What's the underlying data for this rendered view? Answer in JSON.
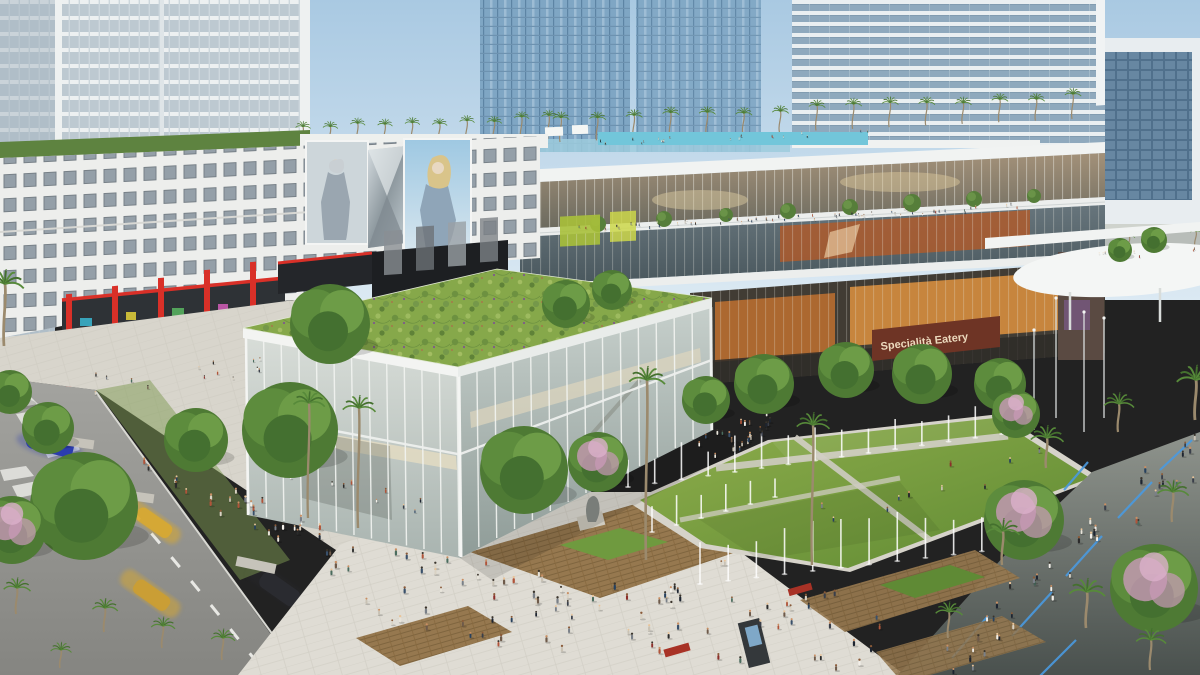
{
  "meta": {
    "title": "Aerial rendering of a mixed-use urban plaza development",
    "type": "architectural-rendering",
    "time_of_day": "day"
  },
  "signs": {
    "eatery": "Specialità Eatery"
  },
  "palette": {
    "sky_top": "#a9c9e2",
    "sky_bottom": "#dbe9f3",
    "green_roof": "#86a84a",
    "lawn_light": "#8fae4c",
    "lawn_dark": "#5f8a33",
    "pavement": "#dfdcd4",
    "promenade": "#5c6360",
    "street": "#9e9e9a",
    "glass_blue": "#7fa6c4",
    "glass_cool": "#55656d",
    "glass_warm": "#97876d",
    "food_hall_glow": "#d98f3f",
    "retail_red": "#d93028",
    "sign_brown": "#6e3425",
    "sign_text": "#ecd9bd",
    "white_structure": "#f1f3f2",
    "palm_green": "#4e7c34",
    "flower_pink": "#c99ab8",
    "led_blue": "#4a9ae0",
    "taxi_yellow": "#d9a92f",
    "car_blue": "#2b3cae",
    "people_colors": [
      "#1d2430",
      "#3a3f4a",
      "#f2efe9",
      "#7a8088",
      "#27415e",
      "#8c2f2a",
      "#c9c2b4",
      "#4a6c5e",
      "#2b2b2b",
      "#6e5a4a",
      "#b0543a",
      "#e8e4da",
      "#39506b",
      "#d9d2c4"
    ],
    "skin_tones": [
      "#e8c49a",
      "#c98f63",
      "#8a5a38",
      "#3a342c"
    ]
  },
  "scenery": {
    "palm_rows": [
      {
        "x1": 302,
        "x2": 548,
        "y": 146,
        "m": -0.03,
        "n": 10,
        "t": 18,
        "s": 0.5
      },
      {
        "x1": 560,
        "x2": 1072,
        "y": 142,
        "m": -0.045,
        "n": 15,
        "t": 20,
        "s": 0.55
      },
      {
        "x1": 1095,
        "x2": 1195,
        "y": 252,
        "m": -0.05,
        "n": 4,
        "t": 13,
        "s": 0.38
      }
    ],
    "bush_rows": [
      {
        "x1": 6,
        "x2": 300,
        "y": 152,
        "m": -0.033,
        "n": 16,
        "r": 6
      }
    ],
    "palms": [
      {
        "x": 16,
        "y": 614,
        "t": 26,
        "s": 0.9
      },
      {
        "x": 104,
        "y": 632,
        "t": 24,
        "s": 0.85
      },
      {
        "x": 162,
        "y": 648,
        "t": 22,
        "s": 0.8
      },
      {
        "x": 222,
        "y": 660,
        "t": 22,
        "s": 0.8
      },
      {
        "x": 60,
        "y": 668,
        "t": 18,
        "s": 0.7
      },
      {
        "x": 4,
        "y": 346,
        "t": 62,
        "s": 1.25
      },
      {
        "x": 308,
        "y": 518,
        "t": 115,
        "s": 1.05
      },
      {
        "x": 358,
        "y": 528,
        "t": 120,
        "s": 1.1
      },
      {
        "x": 646,
        "y": 560,
        "t": 180,
        "s": 1.2
      },
      {
        "x": 812,
        "y": 565,
        "t": 140,
        "s": 1.1
      },
      {
        "x": 1046,
        "y": 468,
        "t": 30,
        "s": 1.1
      },
      {
        "x": 1118,
        "y": 432,
        "t": 28,
        "s": 1.0
      },
      {
        "x": 1002,
        "y": 565,
        "t": 34,
        "s": 1.1
      },
      {
        "x": 1086,
        "y": 628,
        "t": 36,
        "s": 1.2
      },
      {
        "x": 1172,
        "y": 522,
        "t": 30,
        "s": 1.05
      },
      {
        "x": 1150,
        "y": 670,
        "t": 30,
        "s": 1.0
      },
      {
        "x": 948,
        "y": 638,
        "t": 26,
        "s": 0.9
      },
      {
        "x": 1195,
        "y": 420,
        "t": 40,
        "s": 1.3
      }
    ],
    "trees": [
      {
        "x": 84,
        "y": 506,
        "r": 54
      },
      {
        "x": 290,
        "y": 430,
        "r": 48
      },
      {
        "x": 196,
        "y": 440,
        "r": 32
      },
      {
        "x": 524,
        "y": 470,
        "r": 44
      },
      {
        "x": 330,
        "y": 324,
        "r": 40
      },
      {
        "x": 48,
        "y": 428,
        "r": 26
      },
      {
        "x": 10,
        "y": 392,
        "r": 22
      },
      {
        "x": 764,
        "y": 384,
        "r": 30
      },
      {
        "x": 846,
        "y": 370,
        "r": 28
      },
      {
        "x": 922,
        "y": 374,
        "r": 30
      },
      {
        "x": 1000,
        "y": 384,
        "r": 26
      },
      {
        "x": 706,
        "y": 400,
        "r": 24
      },
      {
        "x": 566,
        "y": 304,
        "r": 24
      },
      {
        "x": 612,
        "y": 290,
        "r": 20
      },
      {
        "x": 1120,
        "y": 250,
        "r": 12
      },
      {
        "x": 1154,
        "y": 240,
        "r": 13
      }
    ],
    "pink_trees": [
      {
        "x": 1024,
        "y": 520,
        "r": 40
      },
      {
        "x": 1154,
        "y": 588,
        "r": 44
      },
      {
        "x": 1016,
        "y": 414,
        "r": 24
      },
      {
        "x": 598,
        "y": 462,
        "r": 30
      },
      {
        "x": 12,
        "y": 530,
        "r": 34
      }
    ],
    "terrace_trees": [
      {
        "x": 598,
        "y": 224,
        "r": 8
      },
      {
        "x": 664,
        "y": 219,
        "r": 8
      },
      {
        "x": 726,
        "y": 215,
        "r": 7
      },
      {
        "x": 788,
        "y": 211,
        "r": 8
      },
      {
        "x": 850,
        "y": 207,
        "r": 8
      },
      {
        "x": 912,
        "y": 203,
        "r": 9
      },
      {
        "x": 974,
        "y": 199,
        "r": 8
      },
      {
        "x": 1034,
        "y": 196,
        "r": 7
      }
    ],
    "fountain_rows": [
      {
        "x1": 628,
        "y1": 487,
        "x2": 1002,
        "y2": 434,
        "n": 15,
        "h": 30
      },
      {
        "x1": 700,
        "y1": 584,
        "x2": 1010,
        "y2": 548,
        "n": 12,
        "h": 42
      },
      {
        "x1": 652,
        "y1": 532,
        "x2": 775,
        "y2": 497,
        "n": 6,
        "h": 24
      }
    ],
    "crowds": [
      {
        "x0": 360,
        "w": 520,
        "y0": 548,
        "m": 0.1,
        "h": 85,
        "n": 90,
        "s": 1.0
      },
      {
        "x0": 140,
        "w": 215,
        "y0": 428,
        "m": 0.55,
        "h": 45,
        "n": 36,
        "s": 1.0
      },
      {
        "x0": 945,
        "w": 250,
        "y0": 640,
        "m": -0.85,
        "h": 55,
        "n": 44,
        "s": 1.0,
        "dim": true
      },
      {
        "x0": 690,
        "w": 80,
        "y0": 440,
        "m": -0.35,
        "h": 30,
        "n": 24,
        "s": 0.85
      },
      {
        "x0": 720,
        "w": 330,
        "y0": 540,
        "m": -0.32,
        "h": 35,
        "n": 12,
        "s": 0.9
      },
      {
        "x0": 556,
        "w": 480,
        "y0": 228,
        "m": -0.052,
        "h": 7,
        "n": 60,
        "s": 0.45
      },
      {
        "x0": 600,
        "w": 270,
        "y0": 141,
        "m": -0.04,
        "h": 5,
        "n": 22,
        "s": 0.4
      },
      {
        "x0": 68,
        "w": 195,
        "y0": 378,
        "m": -0.1,
        "h": 20,
        "n": 14,
        "s": 0.6
      },
      {
        "x0": 270,
        "w": 170,
        "y0": 455,
        "m": 0.3,
        "h": 30,
        "n": 10,
        "s": 0.7,
        "dim": true
      },
      {
        "x0": 1090,
        "w": 105,
        "y0": 254,
        "m": -0.04,
        "h": 6,
        "n": 8,
        "s": 0.4
      }
    ],
    "light_masts": [
      {
        "x": 1056,
        "y1": 418,
        "y2": 298
      },
      {
        "x": 1084,
        "y1": 432,
        "y2": 312
      },
      {
        "x": 1034,
        "y1": 430,
        "y2": 330
      },
      {
        "x": 1104,
        "y1": 418,
        "y2": 318
      }
    ]
  }
}
